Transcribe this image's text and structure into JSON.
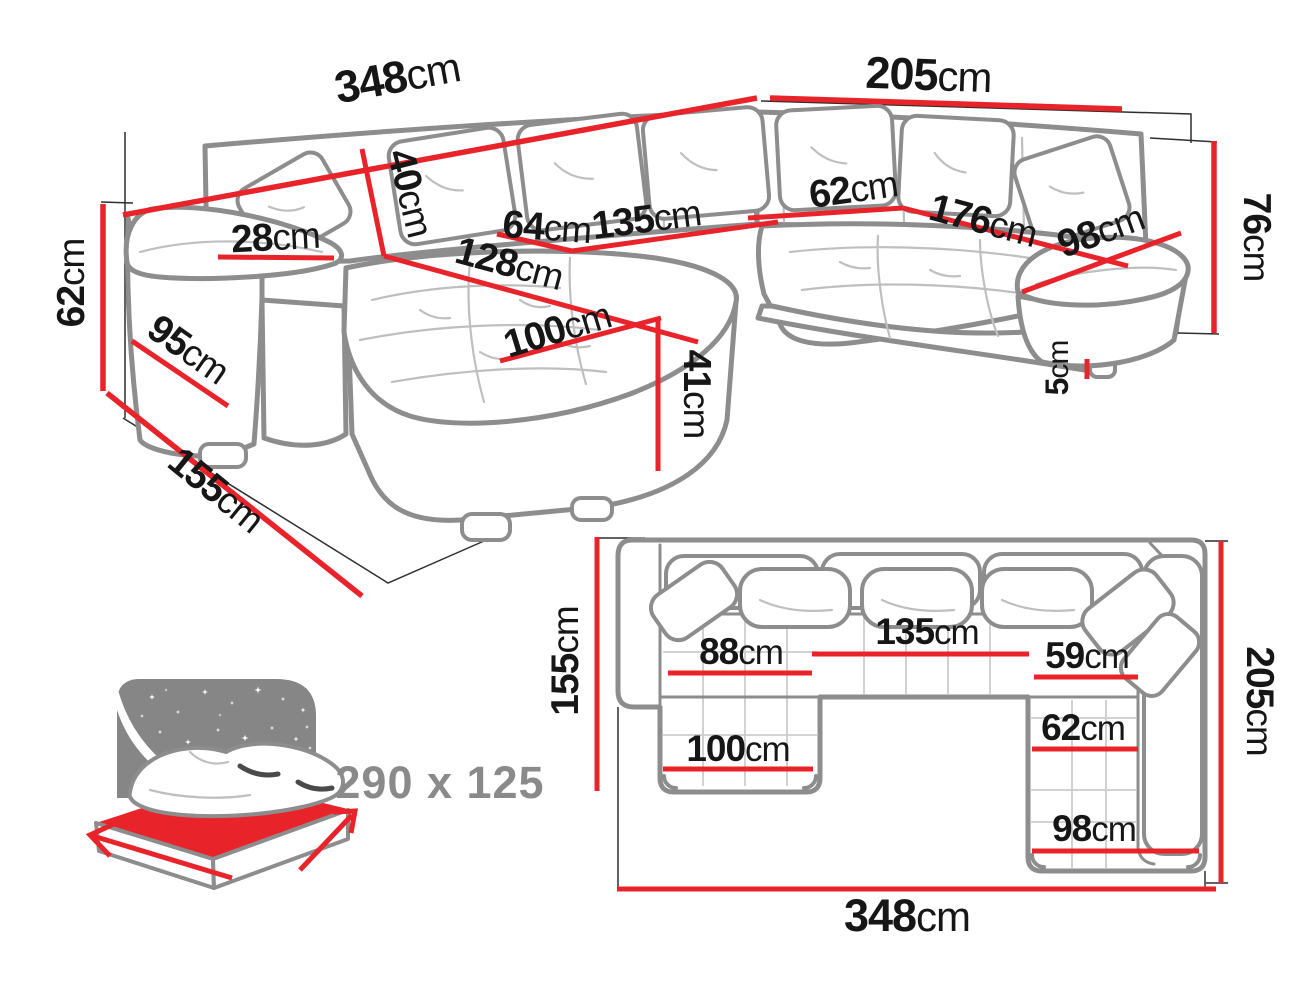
{
  "colors": {
    "dimension_red": "#e8232a",
    "sofa_outline_gray": "#8d8d8d",
    "label_black": "#161616",
    "icon_gray": "#868686",
    "icon_text_gray": "#8a8a8a"
  },
  "perspective_view": {
    "dims": {
      "back_width": {
        "num": "348",
        "unit": "cm"
      },
      "right_back_width": {
        "num": "205",
        "unit": "cm"
      },
      "total_height": {
        "num": "76",
        "unit": "cm"
      },
      "arm_height": {
        "num": "62",
        "unit": "cm"
      },
      "backrest_height": {
        "num": "40",
        "unit": "cm"
      },
      "arm_top_width": {
        "num": "28",
        "unit": "cm"
      },
      "arm_depth": {
        "num": "95",
        "unit": "cm"
      },
      "chaise_depth_total": {
        "num": "155",
        "unit": "cm"
      },
      "chaise_seat_length": {
        "num": "128",
        "unit": "cm"
      },
      "seat_depth": {
        "num": "64",
        "unit": "cm"
      },
      "middle_seat_width": {
        "num": "135",
        "unit": "cm"
      },
      "corner_seat_width": {
        "num": "62",
        "unit": "cm"
      },
      "right_seat_length": {
        "num": "176",
        "unit": "cm"
      },
      "right_seat_depth": {
        "num": "98",
        "unit": "cm"
      },
      "chaise_width": {
        "num": "100",
        "unit": "cm"
      },
      "seat_height": {
        "num": "41",
        "unit": "cm"
      },
      "leg_height": {
        "num": "5",
        "unit": "cm"
      }
    }
  },
  "top_view": {
    "dims": {
      "left_depth": {
        "num": "155",
        "unit": "cm"
      },
      "chaise_seat_width": {
        "num": "88",
        "unit": "cm"
      },
      "middle_seat_width": {
        "num": "135",
        "unit": "cm"
      },
      "corner_seat_width": {
        "num": "59",
        "unit": "cm"
      },
      "right_seat_width": {
        "num": "62",
        "unit": "cm"
      },
      "chaise_width": {
        "num": "100",
        "unit": "cm"
      },
      "right_return_width": {
        "num": "98",
        "unit": "cm"
      },
      "total_depth": {
        "num": "205",
        "unit": "cm"
      },
      "total_width": {
        "num": "348",
        "unit": "cm"
      }
    }
  },
  "sleeping_area": {
    "label": "290 x 125"
  }
}
